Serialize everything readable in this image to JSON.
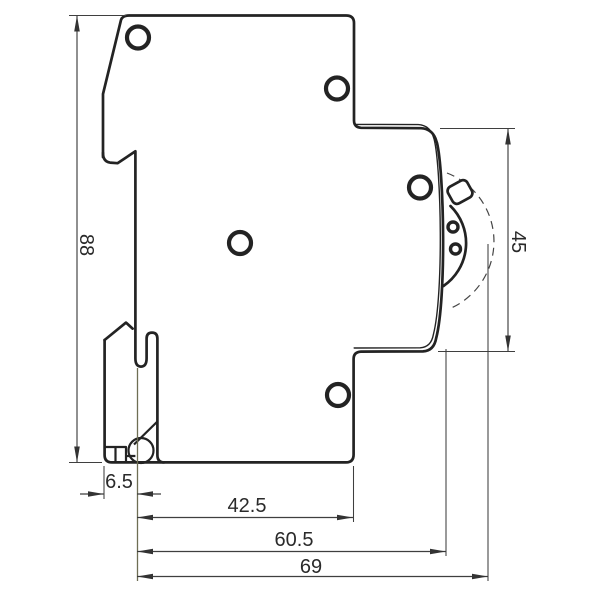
{
  "drawing": {
    "dimensions": {
      "height": "88",
      "switch_zone": "45",
      "rail_clip_offset": "6.5",
      "body_depth": "42.5",
      "front_depth": "60.5",
      "total_depth": "69"
    },
    "colors": {
      "line": "#232323",
      "dimension": "#3f3f3f",
      "extension_accent": "#6e6e54",
      "background": "#ffffff",
      "text": "#2a2a2a"
    }
  }
}
